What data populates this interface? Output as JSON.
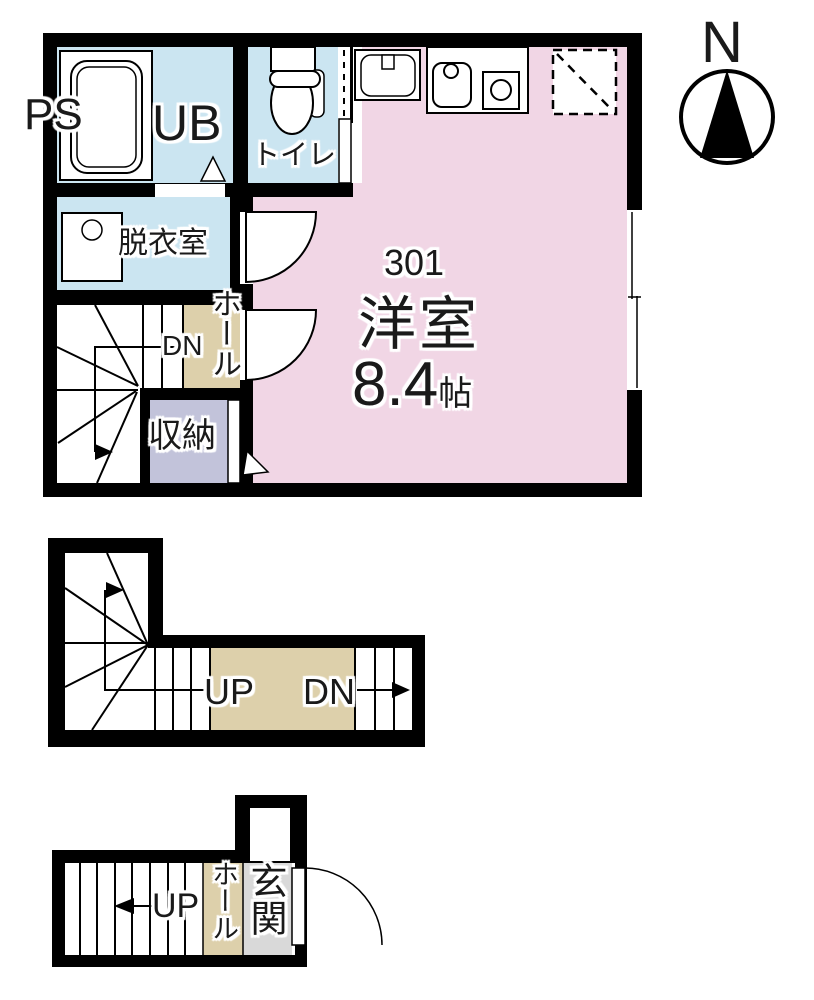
{
  "compass": {
    "north": "N"
  },
  "floor3": {
    "ps": "PS",
    "ub": "UB",
    "toilet": "トイレ",
    "dressing": "脱衣室",
    "dn": "DN",
    "hall": "ホール",
    "storage": "収納",
    "unit_no": "301",
    "room_name": "洋室",
    "size_value": "8.4",
    "size_unit": "帖"
  },
  "floor2": {
    "up": "UP",
    "dn": "DN"
  },
  "floor1": {
    "hall": "ホール",
    "entrance": "玄関",
    "up": "UP"
  },
  "colors": {
    "wall": "#000000",
    "room_pink": "#f1d6e5",
    "wet_blue": "#cbe5f1",
    "hall_beige": "#ddd0ab",
    "storage_lavender": "#c2c3da",
    "entrance_gray": "#d9d9d9",
    "floor_white": "#ffffff"
  },
  "icons": [
    "bathtub-icon",
    "toilet-icon",
    "washbasin-icon",
    "kitchen-sink-icon",
    "stove-burner-icon",
    "refrigerator-space-icon",
    "washing-machine-icon",
    "sliding-window-icon",
    "door-swing-arc-icon",
    "stair-treads-icon",
    "direction-arrow-icon",
    "compass-north-icon"
  ]
}
